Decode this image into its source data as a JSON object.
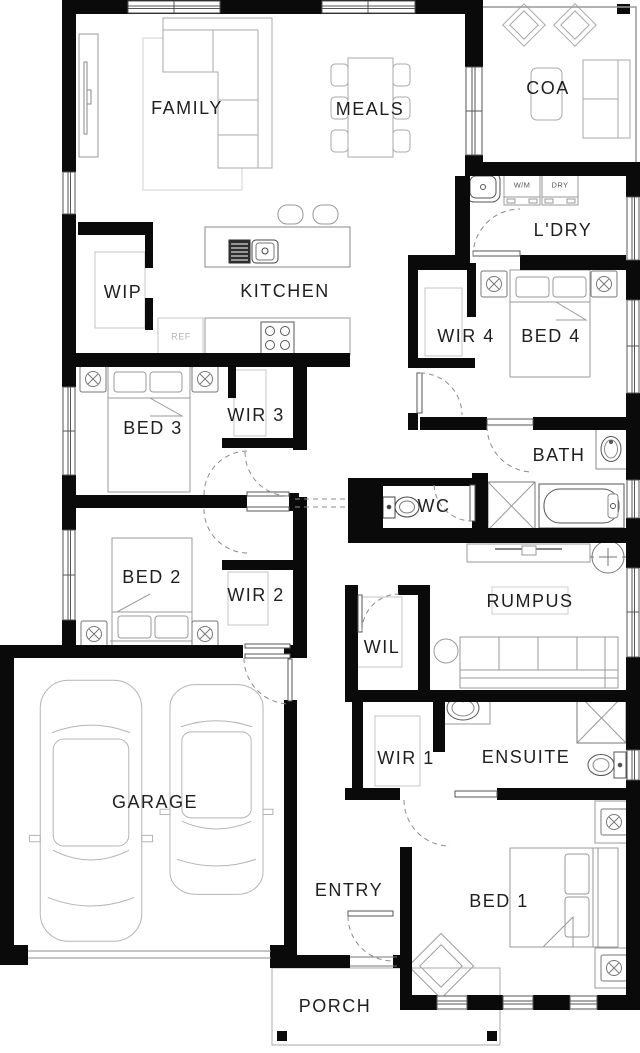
{
  "plan": {
    "rooms": {
      "family": "FAMILY",
      "meals": "MEALS",
      "coa": "COA",
      "ldry": "L'DRY",
      "wip": "WIP",
      "kitchen": "KITCHEN",
      "wir4": "WIR 4",
      "bed4": "BED 4",
      "bed3": "BED 3",
      "wir3": "WIR 3",
      "bath": "BATH",
      "wc": "WC",
      "bed2": "BED 2",
      "wir2": "WIR 2",
      "rumpus": "RUMPUS",
      "wil": "WIL",
      "garage": "GARAGE",
      "wir1": "WIR 1",
      "ensuite": "ENSUITE",
      "entry": "ENTRY",
      "bed1": "BED 1",
      "porch": "PORCH"
    },
    "appliances": {
      "wm": "W/M",
      "dry": "DRY",
      "ref": "REF"
    },
    "colors": {
      "wall": "#0a0a0a",
      "furniture": "#9a9a9a",
      "fixture": "#555555",
      "door_arc": "#8a8a8a"
    }
  }
}
